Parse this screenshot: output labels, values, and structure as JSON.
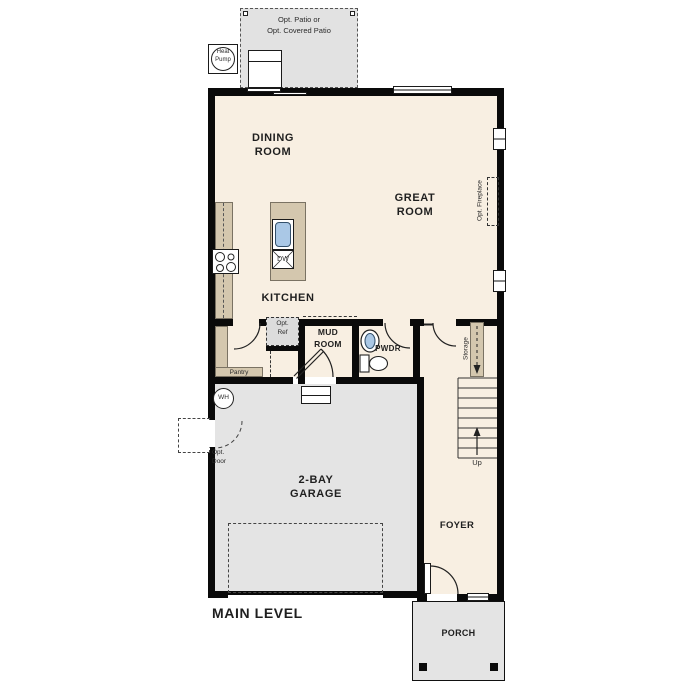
{
  "title": "MAIN LEVEL",
  "colors": {
    "floor": "#f8efe2",
    "garage": "#e4e4e4",
    "patio": "#e2e2e2",
    "counter": "#d4c7ae",
    "sink": "#aac8e6",
    "wall": "#0a0a0a",
    "text": "#1f1f1f"
  },
  "rooms": {
    "dining_line1": "DINING",
    "dining_line2": "ROOM",
    "great_line1": "GREAT",
    "great_line2": "ROOM",
    "kitchen": "KITCHEN",
    "mud_line1": "MUD",
    "mud_line2": "ROOM",
    "pwdr": "PWDR",
    "garage_line1": "2-BAY",
    "garage_line2": "GARAGE",
    "foyer": "FOYER",
    "porch": "PORCH"
  },
  "features": {
    "patio_line1": "Opt. Patio or",
    "patio_line2": "Opt. Covered Patio",
    "heat_pump_line1": "Heat",
    "heat_pump_line2": "Pump",
    "opt_fireplace": "Opt. Fireplace",
    "opt_ref_line1": "Opt.",
    "opt_ref_line2": "Ref",
    "dw": "DW",
    "pantry": "Pantry",
    "wh": "WH",
    "opt_door_line1": "Opt.",
    "opt_door_line2": "Door",
    "storage": "Storage",
    "up": "Up"
  }
}
